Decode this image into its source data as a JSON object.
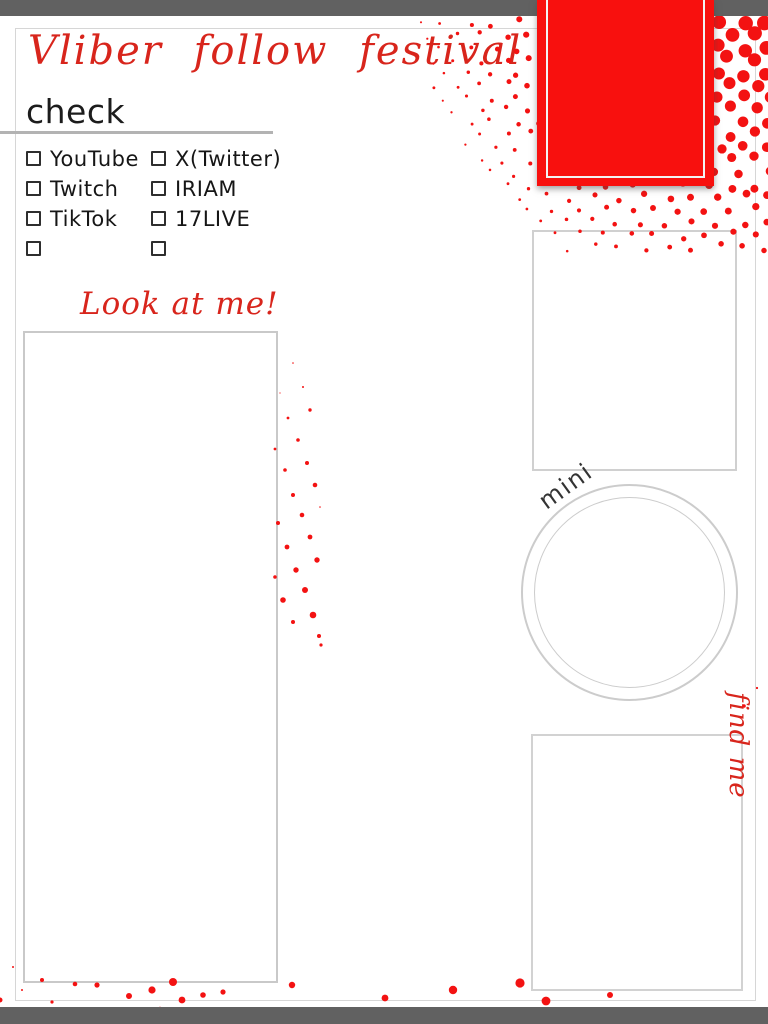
{
  "header": {
    "title": "Vliber follow festival",
    "section_heading": "check"
  },
  "checklist": {
    "platforms_left": [
      "YouTube",
      "Twitch",
      "TikTok",
      ""
    ],
    "platforms_right": [
      "X(Twitter)",
      "IRIAM",
      "17LIVE",
      ""
    ]
  },
  "captions": {
    "look_at_me": "Look at me!",
    "mini": "mini",
    "find_me": "find me"
  },
  "colors": {
    "accent_red": "#f8100e",
    "dot_red": "#f31212",
    "script_red": "#d8251c",
    "bar_gray": "#616161",
    "frame_gray": "#c9c9c9",
    "text_black": "#161616"
  }
}
